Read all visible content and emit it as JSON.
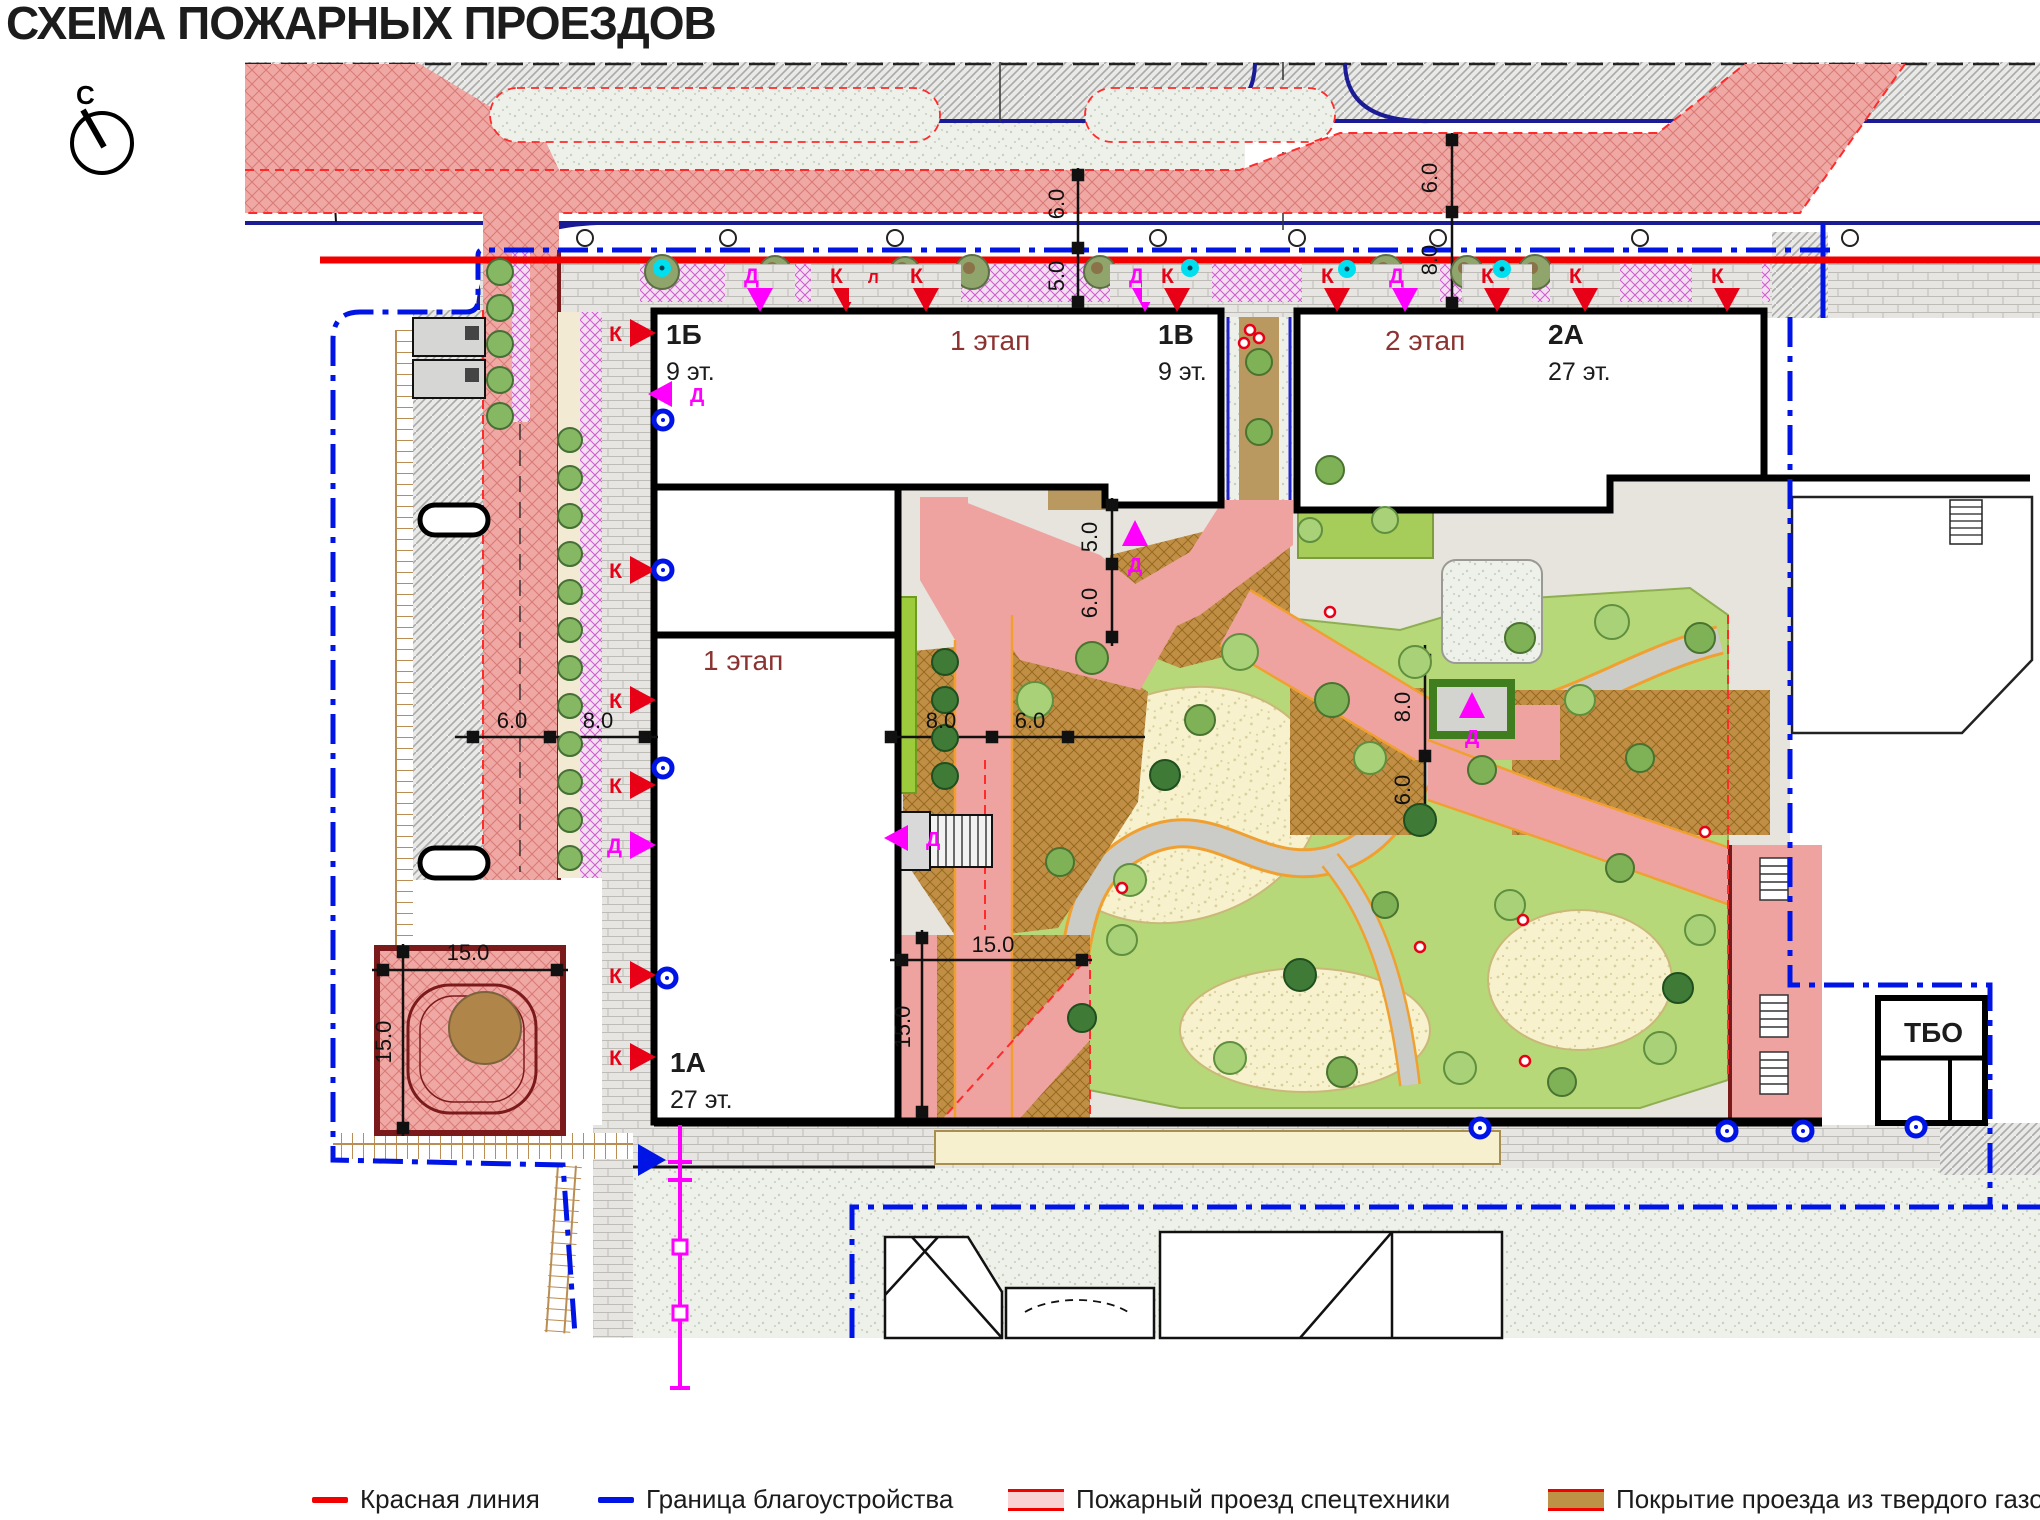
{
  "title": "СХЕМА ПОЖАРНЫХ ПРОЕЗДОВ",
  "north": {
    "label": "С"
  },
  "colors": {
    "red_line": "#f20000",
    "boundary_blue": "#0014e6",
    "fire_pink": "#f0a8a4",
    "hard_lawn_brown": "#bd9146",
    "marker_red": "#e80016",
    "marker_magenta": "#ff00ff",
    "stage_text": "#8b3331"
  },
  "buildings": [
    {
      "label": "1Б",
      "floors": "9 эт.",
      "x": 666,
      "y": 344
    },
    {
      "label": "1В",
      "floors": "9 эт.",
      "x": 1158,
      "y": 344
    },
    {
      "label": "2А",
      "floors": "27 эт.",
      "x": 1548,
      "y": 344
    },
    {
      "label": "1А",
      "floors": "27 эт.",
      "x": 670,
      "y": 1072
    },
    {
      "label": "ТБО",
      "floors": "",
      "x": 1904,
      "y": 1042
    }
  ],
  "stages": [
    {
      "label": "1 этап",
      "x": 950,
      "y": 350
    },
    {
      "label": "2 этап",
      "x": 1385,
      "y": 350
    },
    {
      "label": "1 этап",
      "x": 703,
      "y": 670
    }
  ],
  "dimensions": [
    {
      "v": "6.0",
      "x": 1064,
      "y": 204,
      "rot": 1
    },
    {
      "v": "5.0",
      "x": 1064,
      "y": 276,
      "rot": 1
    },
    {
      "v": "6.0",
      "x": 1437,
      "y": 178,
      "rot": 1
    },
    {
      "v": "8.0",
      "x": 1437,
      "y": 260,
      "rot": 1
    },
    {
      "v": "5.0",
      "x": 1097,
      "y": 537,
      "rot": 1
    },
    {
      "v": "6.0",
      "x": 1097,
      "y": 603,
      "rot": 1
    },
    {
      "v": "8.0",
      "x": 1410,
      "y": 707,
      "rot": 1
    },
    {
      "v": "6.0",
      "x": 1410,
      "y": 790,
      "rot": 1
    },
    {
      "v": "6.0",
      "x": 512,
      "y": 728
    },
    {
      "v": "8.0",
      "x": 598,
      "y": 728
    },
    {
      "v": "8.0",
      "x": 941,
      "y": 728
    },
    {
      "v": "6.0",
      "x": 1030,
      "y": 728
    },
    {
      "v": "15.0",
      "x": 468,
      "y": 960
    },
    {
      "v": "15.0",
      "x": 391,
      "y": 1042,
      "rot": 1
    },
    {
      "v": "15.0",
      "x": 993,
      "y": 952
    },
    {
      "v": "15.0",
      "x": 910,
      "y": 1027,
      "rot": 1
    }
  ],
  "markers": {
    "top": [
      {
        "x": 760,
        "l": "Д",
        "c": "m"
      },
      {
        "x": 846,
        "l": "К",
        "c": "r"
      },
      {
        "x": 884,
        "l": "Л",
        "c": "r",
        "s": 1
      },
      {
        "x": 926,
        "l": "К",
        "c": "r"
      },
      {
        "x": 1145,
        "l": "Д",
        "c": "m"
      },
      {
        "x": 1177,
        "l": "К",
        "c": "r"
      },
      {
        "x": 1337,
        "l": "К",
        "c": "r"
      },
      {
        "x": 1405,
        "l": "Д",
        "c": "m"
      },
      {
        "x": 1497,
        "l": "К",
        "c": "r"
      },
      {
        "x": 1585,
        "l": "К",
        "c": "r"
      },
      {
        "x": 1727,
        "l": "К",
        "c": "r"
      }
    ],
    "west": [
      {
        "y": 333,
        "l": "К",
        "c": "r"
      },
      {
        "y": 570,
        "l": "К",
        "c": "r"
      },
      {
        "y": 700,
        "l": "К",
        "c": "r"
      },
      {
        "y": 785,
        "l": "К",
        "c": "r"
      },
      {
        "y": 845,
        "l": "Д",
        "c": "m"
      },
      {
        "y": 975,
        "l": "К",
        "c": "r"
      },
      {
        "y": 1057,
        "l": "К",
        "c": "r"
      }
    ],
    "inner": [
      {
        "x": 672,
        "y": 394,
        "dir": "left",
        "l": "Д"
      },
      {
        "x": 908,
        "y": 838,
        "dir": "left",
        "l": "Д"
      },
      {
        "x": 1135,
        "y": 534,
        "dir": "up",
        "l": "Д"
      },
      {
        "x": 1472,
        "y": 706,
        "dir": "up",
        "l": "Д"
      }
    ],
    "blue_rings": [
      [
        663,
        420
      ],
      [
        663,
        570
      ],
      [
        663,
        768
      ],
      [
        667,
        978
      ],
      [
        1480,
        1128
      ],
      [
        1727,
        1131
      ],
      [
        1803,
        1131
      ],
      [
        1916,
        1127
      ]
    ],
    "cyan_dots": [
      [
        662,
        268
      ],
      [
        1190,
        268
      ],
      [
        1347,
        269
      ],
      [
        1502,
        269
      ]
    ],
    "red_dots": [
      [
        1250,
        330
      ],
      [
        1259,
        338
      ],
      [
        1244,
        343
      ],
      [
        1330,
        612
      ],
      [
        1420,
        947
      ],
      [
        1523,
        920
      ],
      [
        1525,
        1061
      ],
      [
        1705,
        832
      ],
      [
        1122,
        888
      ]
    ],
    "blue_arrow": {
      "x": 650,
      "y": 1160
    }
  },
  "legend": {
    "items": [
      {
        "type": "line",
        "color": "#f20000",
        "label": "Красная линия"
      },
      {
        "type": "line",
        "color": "#0014e6",
        "label": "Граница благоустройства"
      },
      {
        "type": "area",
        "fill": "#f9d3d3",
        "border": "#f20000",
        "label": "Пожарный проезд спецтехники"
      },
      {
        "type": "area",
        "fill": "#bd9146",
        "border": "#f20000",
        "label": "Покрытие проезда из твердого газона"
      }
    ]
  }
}
